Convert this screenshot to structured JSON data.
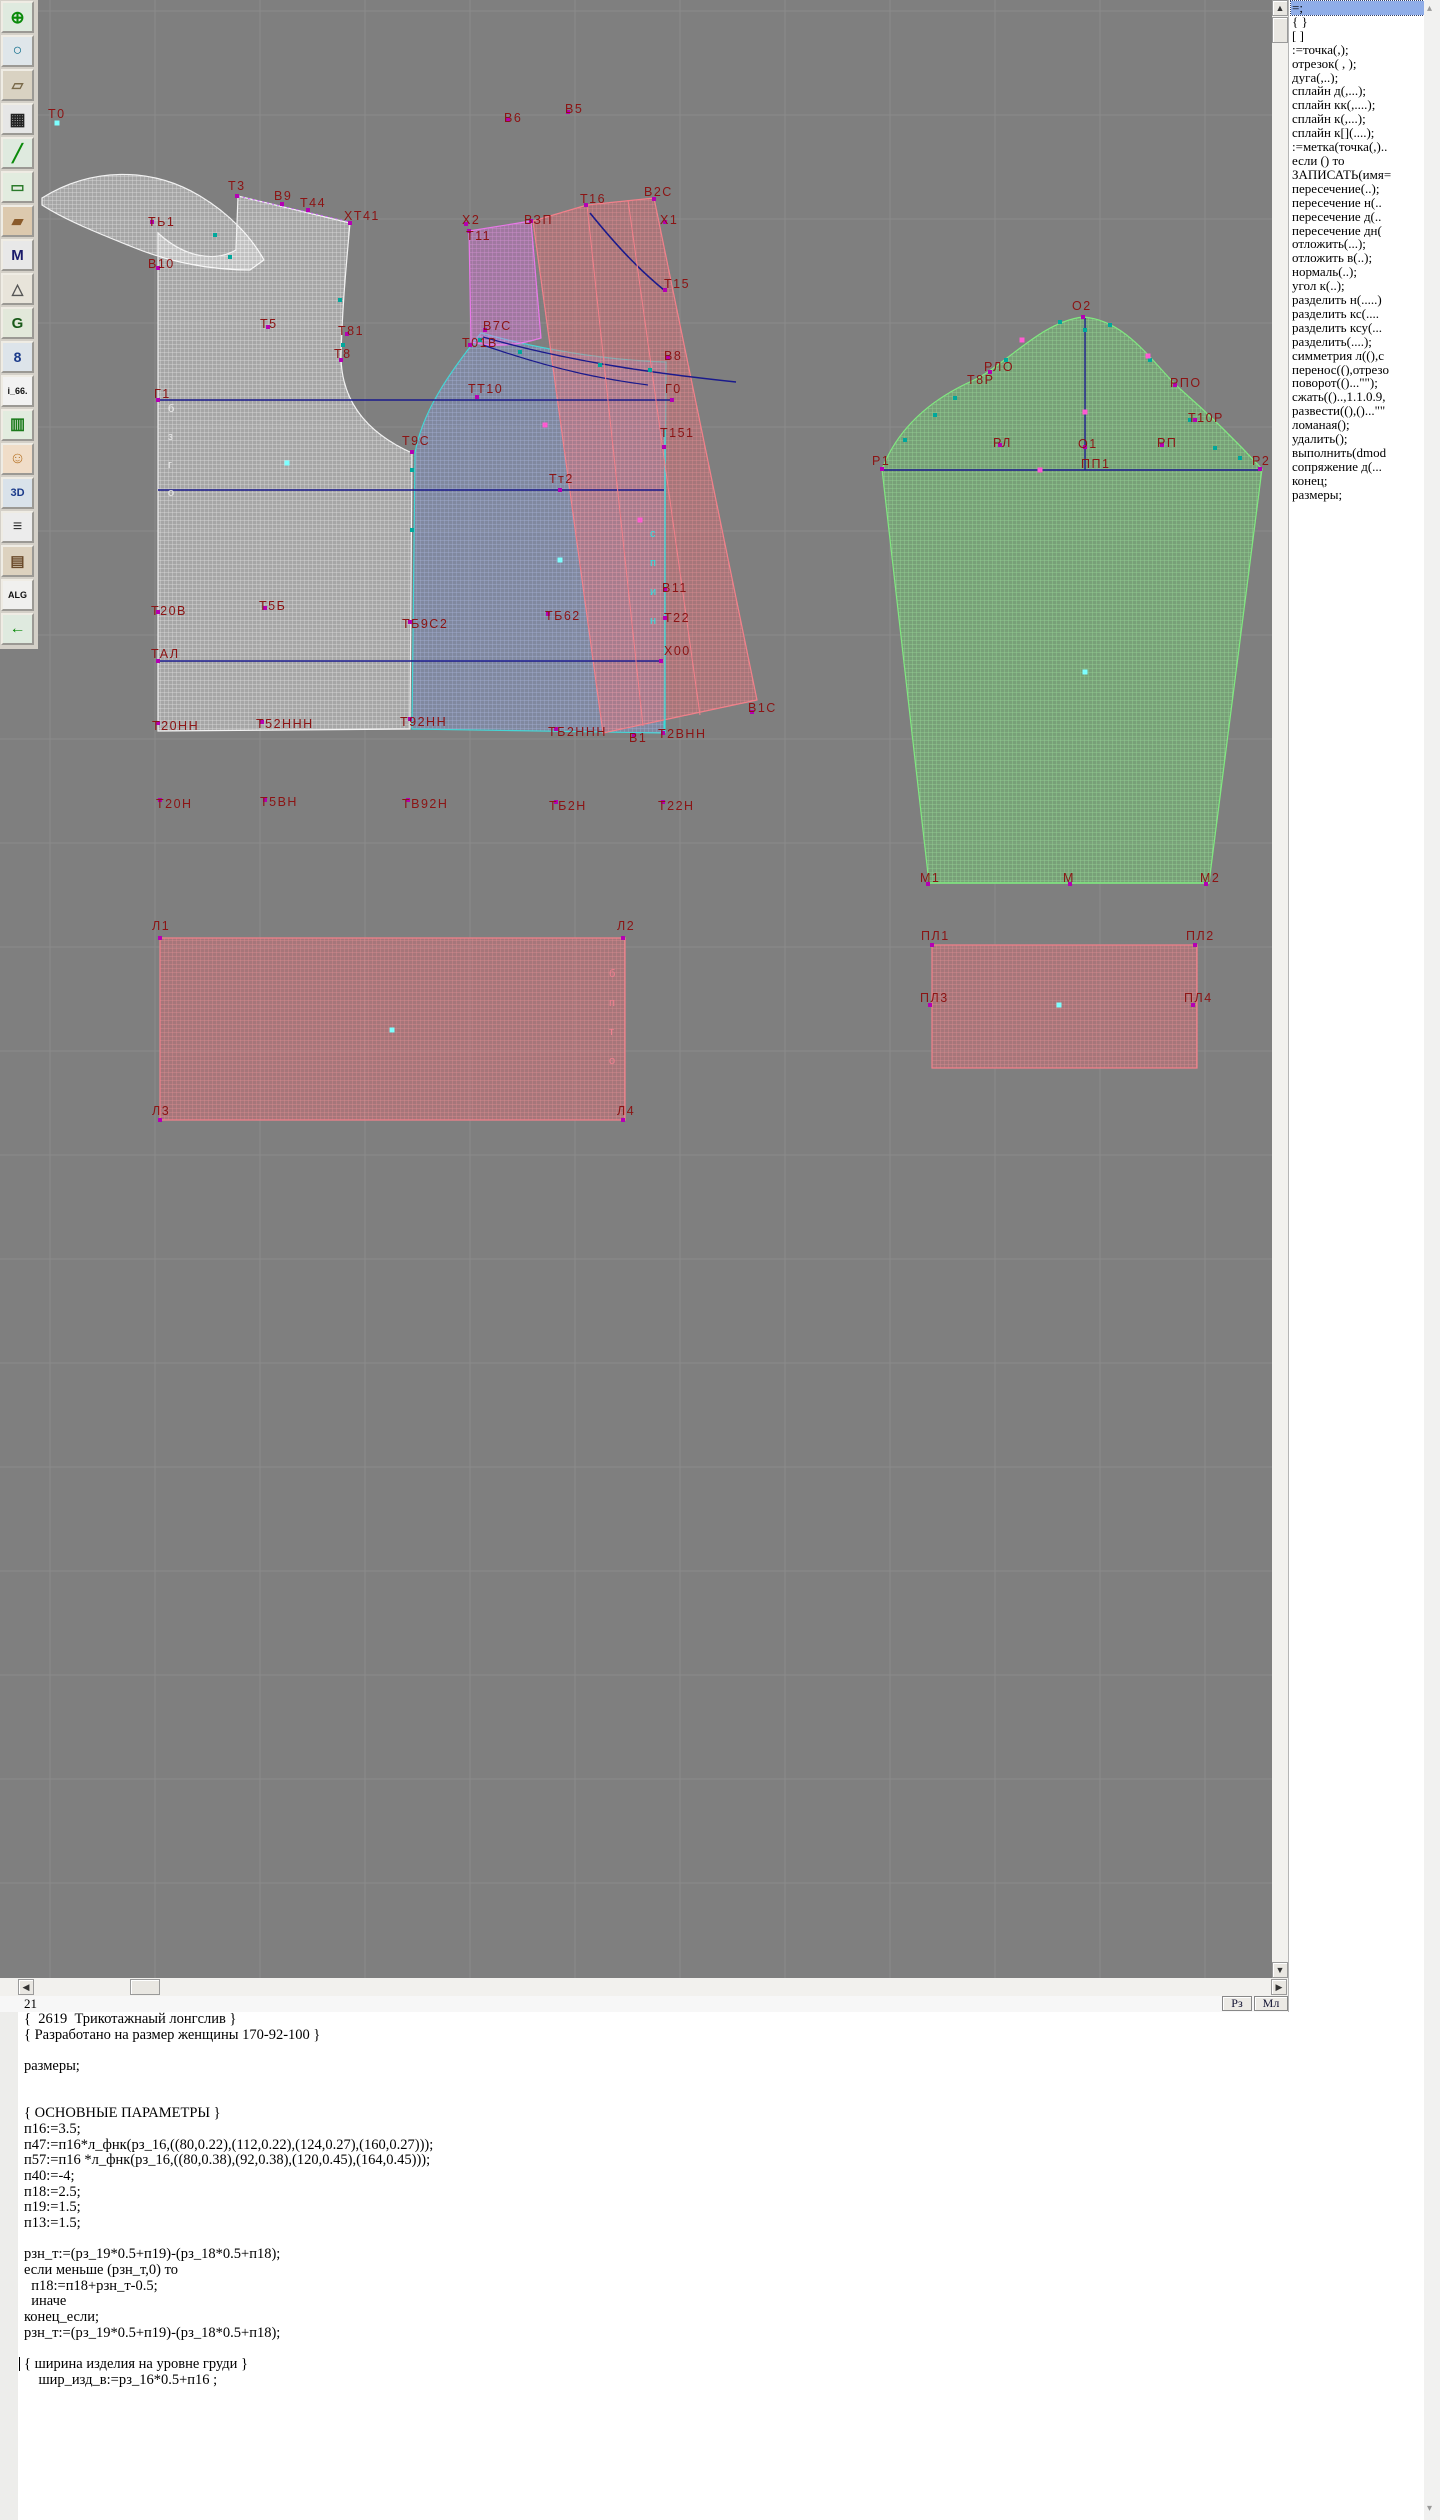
{
  "toolbar": {
    "icons": [
      {
        "name": "zoom-in-icon",
        "glyph": "⊕",
        "fg": "#0a8a0a",
        "bg": "#dfeadf",
        "fs": 17
      },
      {
        "name": "zoom-icon",
        "glyph": "○",
        "fg": "#0a6a8a",
        "bg": "#dfe6ea",
        "fs": 16
      },
      {
        "name": "print-preview-icon",
        "glyph": "▱",
        "fg": "#7a6a4a",
        "bg": "#d9d2c2",
        "fs": 15
      },
      {
        "name": "grid-icon",
        "glyph": "▦",
        "fg": "#222222",
        "bg": "#e6e6e6",
        "fs": 17
      },
      {
        "name": "segment-icon",
        "glyph": "╱",
        "fg": "#0a8a0a",
        "bg": "#dfeadf",
        "fs": 17
      },
      {
        "name": "image-icon",
        "glyph": "▭",
        "fg": "#2a7a2a",
        "bg": "#e2ecdf",
        "fs": 15
      },
      {
        "name": "pattern-piece-icon",
        "glyph": "▰",
        "fg": "#8a5a2a",
        "bg": "#dcc9ae",
        "fs": 15
      },
      {
        "name": "measurements-icon",
        "glyph": "M",
        "fg": "#1a1a6a",
        "bg": "#e8e8e8",
        "fs": 15
      },
      {
        "name": "drafting-tools-icon",
        "glyph": "△",
        "fg": "#555555",
        "bg": "#e8e4da",
        "fs": 15
      },
      {
        "name": "grading-icon",
        "glyph": "G",
        "fg": "#1a5a1a",
        "bg": "#e2e8da",
        "fs": 15
      },
      {
        "name": "ruler-icon",
        "glyph": "8",
        "fg": "#1a3a8a",
        "bg": "#dde4ea",
        "fs": 14
      },
      {
        "name": "file-i66-icon",
        "glyph": "i_66.",
        "fg": "#111111",
        "bg": "#f2f2f2",
        "fs": 9
      },
      {
        "name": "size-table-icon",
        "glyph": "▥",
        "fg": "#1a7a1a",
        "bg": "#e2ecdf",
        "fs": 16
      },
      {
        "name": "model-photo-icon",
        "glyph": "☺",
        "fg": "#b8762a",
        "bg": "#f0ddc8",
        "fs": 16
      },
      {
        "name": "view-3d-icon",
        "glyph": "3D",
        "fg": "#1a3a8a",
        "bg": "#d9e2ea",
        "fs": 11
      },
      {
        "name": "text-list-icon",
        "glyph": "≡",
        "fg": "#333333",
        "bg": "#ececec",
        "fs": 16
      },
      {
        "name": "docs-icon",
        "glyph": "▤",
        "fg": "#6a4a2a",
        "bg": "#ddd2bf",
        "fs": 15
      },
      {
        "name": "algorithms-icon",
        "glyph": "ALG",
        "fg": "#111111",
        "bg": "#f0f0ee",
        "fs": 9
      },
      {
        "name": "exit-icon",
        "glyph": "←",
        "fg": "#0a8a0a",
        "bg": "#dfeadf",
        "fs": 16
      }
    ]
  },
  "canvas": {
    "background": "#7f7f7f",
    "grid": {
      "x0": 50,
      "y0": 11,
      "step_x": 105,
      "step_y": 104,
      "color": "#8b8b8b"
    },
    "pieces": [
      {
        "name": "back-neckband",
        "pat": "hW",
        "stroke": "#f2f2f2",
        "d": "M42,198 C90,168 150,166 200,196 C230,214 252,238 264,260 L250,270 C210,270 170,262 135,248 C100,234 65,220 42,205 Z"
      },
      {
        "name": "back-bodice",
        "pat": "hW",
        "stroke": "#f2f2f2",
        "d": "M158,233 C185,258 215,262 236,250 L238,196 L350,223 C346,268 342,310 341,358 C342,400 365,432 412,453 L410,729 L158,731 Z"
      },
      {
        "name": "front-bodice",
        "pat": "hB",
        "stroke": "#45d6d6",
        "d": "M481,333 C445,378 422,414 415,453 L412,729 L664,733 L666,362 C600,360 535,348 481,333 Z"
      },
      {
        "name": "upper-sleeve-part",
        "pat": "hM",
        "stroke": "#e878e8",
        "d": "M469,231 L531,221 L541,338 C516,346 492,347 471,342 Z"
      },
      {
        "name": "sleeve-overlay",
        "pat": "hR",
        "stroke": "#f2808a",
        "d": "M533,221 L587,205 L654,198 L757,700 L603,733 Z"
      },
      {
        "name": "sleeve",
        "pat": "hG",
        "stroke": "#80e880",
        "d": "M882,469 C898,428 930,400 972,381 C1005,366 1040,322 1083,317 C1126,320 1152,362 1178,387 C1210,415 1240,445 1262,469 L1209,883 L929,883 Z"
      },
      {
        "name": "band-rect-large",
        "pat": "hR",
        "stroke": "#f2808a",
        "d": "M160,938 L625,938 L625,1120 L160,1120 Z"
      },
      {
        "name": "band-rect-small",
        "pat": "hR",
        "stroke": "#f2808a",
        "d": "M932,945 L1197,945 L1197,1068 L932,1068 Z"
      }
    ],
    "lines": [
      {
        "d": "M158,400 L672,400",
        "color": "#1a1a8c",
        "w": 1.4
      },
      {
        "d": "M158,490 L664,490",
        "color": "#1a1a8c",
        "w": 1.4
      },
      {
        "d": "M158,661 L661,661",
        "color": "#1a1a8c",
        "w": 1.4
      },
      {
        "d": "M590,213 C620,250 640,270 664,290",
        "color": "#1a1a8c",
        "w": 1.6
      },
      {
        "d": "M483,337 C570,362 660,374 736,382",
        "color": "#1a1a8c",
        "w": 1.4
      },
      {
        "d": "M483,345 C560,372 610,380 648,385",
        "color": "#1a1a8c",
        "w": 1.2
      },
      {
        "d": "M1085,318 L1085,470",
        "color": "#1a1a8c",
        "w": 1.4
      },
      {
        "d": "M882,470 L1262,470",
        "color": "#1a1a8c",
        "w": 1.4
      },
      {
        "d": "M665,430 L665,733",
        "color": "#2ee0e0",
        "w": 1.2
      },
      {
        "d": "M587,205 L643,726",
        "color": "#f2808a",
        "w": 1
      },
      {
        "d": "M628,200 L700,715",
        "color": "#f2808a",
        "w": 1
      },
      {
        "d": "M238,196 L350,222",
        "color": "#d060ff",
        "w": 1,
        "dash": "2,3"
      },
      {
        "d": "M929,883 L1209,883",
        "color": "#80e880",
        "w": 1.4
      }
    ],
    "labels": [
      {
        "t": "Т0",
        "x": 48,
        "y": 118
      },
      {
        "t": "Т3",
        "x": 228,
        "y": 190
      },
      {
        "t": "В9",
        "x": 274,
        "y": 200
      },
      {
        "t": "Т44",
        "x": 300,
        "y": 207
      },
      {
        "t": "ХТ41",
        "x": 344,
        "y": 220
      },
      {
        "t": "ТЬ1",
        "x": 148,
        "y": 226
      },
      {
        "t": "В10",
        "x": 148,
        "y": 268
      },
      {
        "t": "Т5",
        "x": 260,
        "y": 328
      },
      {
        "t": "Т81",
        "x": 338,
        "y": 335
      },
      {
        "t": "Т8",
        "x": 334,
        "y": 358
      },
      {
        "t": "Г1",
        "x": 154,
        "y": 398
      },
      {
        "t": "Т9С",
        "x": 402,
        "y": 445
      },
      {
        "t": "ТТ10",
        "x": 468,
        "y": 393
      },
      {
        "t": "Г0",
        "x": 665,
        "y": 393
      },
      {
        "t": "Т151",
        "x": 660,
        "y": 437
      },
      {
        "t": "Тт2",
        "x": 549,
        "y": 483
      },
      {
        "t": "Т20В",
        "x": 151,
        "y": 615
      },
      {
        "t": "Т5Б",
        "x": 259,
        "y": 610
      },
      {
        "t": "ТБ9С2",
        "x": 402,
        "y": 628
      },
      {
        "t": "ТБ62",
        "x": 545,
        "y": 620
      },
      {
        "t": "ТАЛ",
        "x": 151,
        "y": 658
      },
      {
        "t": "Х00",
        "x": 664,
        "y": 655
      },
      {
        "t": "Т20НН",
        "x": 152,
        "y": 730
      },
      {
        "t": "Т52ННН",
        "x": 256,
        "y": 728
      },
      {
        "t": "Т92НН",
        "x": 400,
        "y": 726
      },
      {
        "t": "ТБ2ННН",
        "x": 548,
        "y": 736
      },
      {
        "t": "В1",
        "x": 629,
        "y": 742
      },
      {
        "t": "Т2ВНН",
        "x": 658,
        "y": 738
      },
      {
        "t": "В1С",
        "x": 748,
        "y": 712
      },
      {
        "t": "Т20Н",
        "x": 156,
        "y": 808
      },
      {
        "t": "Т5ВН",
        "x": 260,
        "y": 806
      },
      {
        "t": "ТВ92Н",
        "x": 402,
        "y": 808
      },
      {
        "t": "ТБ2Н",
        "x": 549,
        "y": 810
      },
      {
        "t": "Т22Н",
        "x": 658,
        "y": 810
      },
      {
        "t": "В6",
        "x": 504,
        "y": 122
      },
      {
        "t": "В5",
        "x": 565,
        "y": 113
      },
      {
        "t": "Х2",
        "x": 462,
        "y": 224
      },
      {
        "t": "Т11",
        "x": 466,
        "y": 240
      },
      {
        "t": "ВЗП",
        "x": 524,
        "y": 224
      },
      {
        "t": "Т16",
        "x": 580,
        "y": 203
      },
      {
        "t": "В2С",
        "x": 644,
        "y": 196
      },
      {
        "t": "Х1",
        "x": 660,
        "y": 224
      },
      {
        "t": "Т15",
        "x": 664,
        "y": 288
      },
      {
        "t": "В7С",
        "x": 483,
        "y": 330
      },
      {
        "t": "Т01В",
        "x": 462,
        "y": 347
      },
      {
        "t": "В8",
        "x": 664,
        "y": 360
      },
      {
        "t": "В11",
        "x": 662,
        "y": 592
      },
      {
        "t": "Т22",
        "x": 664,
        "y": 622
      },
      {
        "t": "О2",
        "x": 1072,
        "y": 310
      },
      {
        "t": "РЛО",
        "x": 984,
        "y": 371
      },
      {
        "t": "Т8Р",
        "x": 967,
        "y": 384
      },
      {
        "t": "РПО",
        "x": 1170,
        "y": 387
      },
      {
        "t": "Т10Р",
        "x": 1188,
        "y": 422
      },
      {
        "t": "РЛ",
        "x": 993,
        "y": 447
      },
      {
        "t": "О1",
        "x": 1078,
        "y": 448
      },
      {
        "t": "ПП1",
        "x": 1081,
        "y": 468
      },
      {
        "t": "РП",
        "x": 1157,
        "y": 447
      },
      {
        "t": "Р1",
        "x": 872,
        "y": 465
      },
      {
        "t": "Р2",
        "x": 1252,
        "y": 465
      },
      {
        "t": "М1",
        "x": 920,
        "y": 882
      },
      {
        "t": "М",
        "x": 1063,
        "y": 882
      },
      {
        "t": "М2",
        "x": 1200,
        "y": 882
      },
      {
        "t": "Л1",
        "x": 152,
        "y": 930
      },
      {
        "t": "Л2",
        "x": 617,
        "y": 930
      },
      {
        "t": "Л3",
        "x": 152,
        "y": 1115
      },
      {
        "t": "Л4",
        "x": 617,
        "y": 1115
      },
      {
        "t": "ПЛ1",
        "x": 921,
        "y": 940
      },
      {
        "t": "ПЛ2",
        "x": 1186,
        "y": 940
      },
      {
        "t": "ПЛ3",
        "x": 920,
        "y": 1002
      },
      {
        "t": "ПЛ4",
        "x": 1184,
        "y": 1002
      }
    ],
    "vertical_texts": [
      {
        "x": 168,
        "y": 412,
        "dy": 28,
        "color": "#e8e8e8",
        "chars": [
          "б",
          "з",
          "г",
          "о"
        ]
      },
      {
        "x": 650,
        "y": 537,
        "dy": 29,
        "color": "#30e0e0",
        "chars": [
          "с",
          "п",
          "и",
          "н"
        ]
      },
      {
        "x": 609,
        "y": 977,
        "dy": 29,
        "color": "#f08090",
        "chars": [
          "б",
          "п",
          "т",
          "о"
        ]
      }
    ],
    "markers": {
      "magenta": [
        [
          152,
          222
        ],
        [
          158,
          268
        ],
        [
          237,
          196
        ],
        [
          282,
          204
        ],
        [
          308,
          210
        ],
        [
          350,
          223
        ],
        [
          268,
          327
        ],
        [
          347,
          334
        ],
        [
          341,
          360
        ],
        [
          158,
          400
        ],
        [
          412,
          452
        ],
        [
          477,
          397
        ],
        [
          672,
          400
        ],
        [
          664,
          447
        ],
        [
          560,
          490
        ],
        [
          158,
          612
        ],
        [
          265,
          608
        ],
        [
          410,
          622
        ],
        [
          548,
          614
        ],
        [
          158,
          661
        ],
        [
          661,
          661
        ],
        [
          158,
          723
        ],
        [
          262,
          722
        ],
        [
          410,
          719
        ],
        [
          556,
          729
        ],
        [
          634,
          735
        ],
        [
          663,
          733
        ],
        [
          752,
          712
        ],
        [
          160,
          800
        ],
        [
          265,
          800
        ],
        [
          408,
          800
        ],
        [
          556,
          802
        ],
        [
          663,
          802
        ],
        [
          469,
          231
        ],
        [
          531,
          221
        ],
        [
          508,
          120
        ],
        [
          568,
          112
        ],
        [
          466,
          224
        ],
        [
          586,
          205
        ],
        [
          654,
          199
        ],
        [
          665,
          222
        ],
        [
          665,
          290
        ],
        [
          485,
          330
        ],
        [
          470,
          345
        ],
        [
          668,
          358
        ],
        [
          665,
          590
        ],
        [
          665,
          618
        ],
        [
          1083,
          317
        ],
        [
          990,
          372
        ],
        [
          1175,
          385
        ],
        [
          1195,
          420
        ],
        [
          1000,
          445
        ],
        [
          1085,
          447
        ],
        [
          1162,
          445
        ],
        [
          882,
          469
        ],
        [
          1260,
          469
        ],
        [
          928,
          884
        ],
        [
          1070,
          884
        ],
        [
          1206,
          884
        ],
        [
          160,
          938
        ],
        [
          623,
          938
        ],
        [
          160,
          1120
        ],
        [
          623,
          1120
        ],
        [
          932,
          945
        ],
        [
          1195,
          945
        ],
        [
          930,
          1005
        ],
        [
          1193,
          1005
        ]
      ],
      "teal": [
        [
          215,
          235
        ],
        [
          230,
          257
        ],
        [
          340,
          300
        ],
        [
          343,
          345
        ],
        [
          412,
          470
        ],
        [
          412,
          530
        ],
        [
          480,
          340
        ],
        [
          520,
          352
        ],
        [
          600,
          365
        ],
        [
          650,
          370
        ],
        [
          1006,
          360
        ],
        [
          955,
          398
        ],
        [
          1060,
          322
        ],
        [
          1110,
          325
        ],
        [
          1150,
          360
        ],
        [
          1190,
          420
        ],
        [
          1215,
          448
        ],
        [
          1240,
          458
        ],
        [
          905,
          440
        ],
        [
          935,
          415
        ],
        [
          1085,
          330
        ]
      ],
      "cyan_dots": [
        [
          57,
          123
        ],
        [
          287,
          463
        ],
        [
          560,
          560
        ],
        [
          1085,
          672
        ],
        [
          392,
          1030
        ],
        [
          1059,
          1005
        ]
      ],
      "pink_dots": [
        [
          1022,
          340
        ],
        [
          1148,
          356
        ],
        [
          1085,
          412
        ],
        [
          1040,
          470
        ],
        [
          545,
          425
        ],
        [
          640,
          520
        ]
      ]
    }
  },
  "scrollbars": {
    "up_arrow": "▲",
    "down_arrow": "▼",
    "left_arrow": "◀",
    "right_arrow": "▶",
    "rail_up": "▴",
    "rail_down": "▾"
  },
  "statusbar": {
    "line_number": "21",
    "buttons": [
      {
        "label": "Рз"
      },
      {
        "label": "Мл"
      }
    ]
  },
  "editor": {
    "lines": [
      "{  2619  Трикотажнаый лонгслив }",
      "{ Разработано на размер женщины 170-92-100 }",
      "",
      "размеры;",
      "",
      "",
      "{ ОСНОВНЫЕ ПАРАМЕТРЫ }",
      "п16:=3.5;",
      "п47:=п16*л_фнк(рз_16,((80,0.22),(112,0.22),(124,0.27),(160,0.27)));",
      "п57:=п16 *л_фнк(рз_16,((80,0.38),(92,0.38),(120,0.45),(164,0.45)));",
      "п40:=-4;",
      "п18:=2.5;",
      "п19:=1.5;",
      "п13:=1.5;",
      "",
      "рзн_т:=(рз_19*0.5+п19)-(рз_18*0.5+п18);",
      "если меньше (рзн_т,0) то",
      "  п18:=п18+рзн_т-0.5;",
      "  иначе",
      "конец_если;",
      "рзн_т:=(рз_19*0.5+п19)-(рз_18*0.5+п18);",
      "",
      "{ ширина изделия на уровне груди }",
      "    шир_изд_в:=рз_16*0.5+п16 ;"
    ],
    "caret_line_index": 22
  },
  "commands": {
    "selected_index": 0,
    "items": [
      "=;",
      "{  }",
      "[  ]",
      ":=точка(,);",
      "отрезок( , );",
      "дуга(,..);",
      "сплайн  д(,...);",
      "сплайн  кк(,....);",
      "сплайн  к(,...);",
      "сплайн  к[](....);",
      ":=метка(точка(,)..",
      "если () то",
      "ЗАПИСАТЬ(имя=",
      "пересечение(..);",
      "пересечение  н(..",
      "пересечение  д(..",
      "пересечение  дн(",
      "отложить(...);",
      "отложить  в(..);",
      "нормаль(..);",
      "угол  к(..);",
      "разделить  н(.....)",
      "разделить  кс(....",
      "разделить  ксу(...",
      "разделить(....);",
      "симметрия  л((),с",
      "перенос((),отрезо",
      "поворот(()...\"\");",
      "сжать(()..,1.1.0.9,",
      "развести((),()...\"\"",
      "ломаная();",
      "удалить();",
      "выполнить(dmod",
      "сопряжение  д(...",
      "конец;",
      "размеры;"
    ]
  }
}
